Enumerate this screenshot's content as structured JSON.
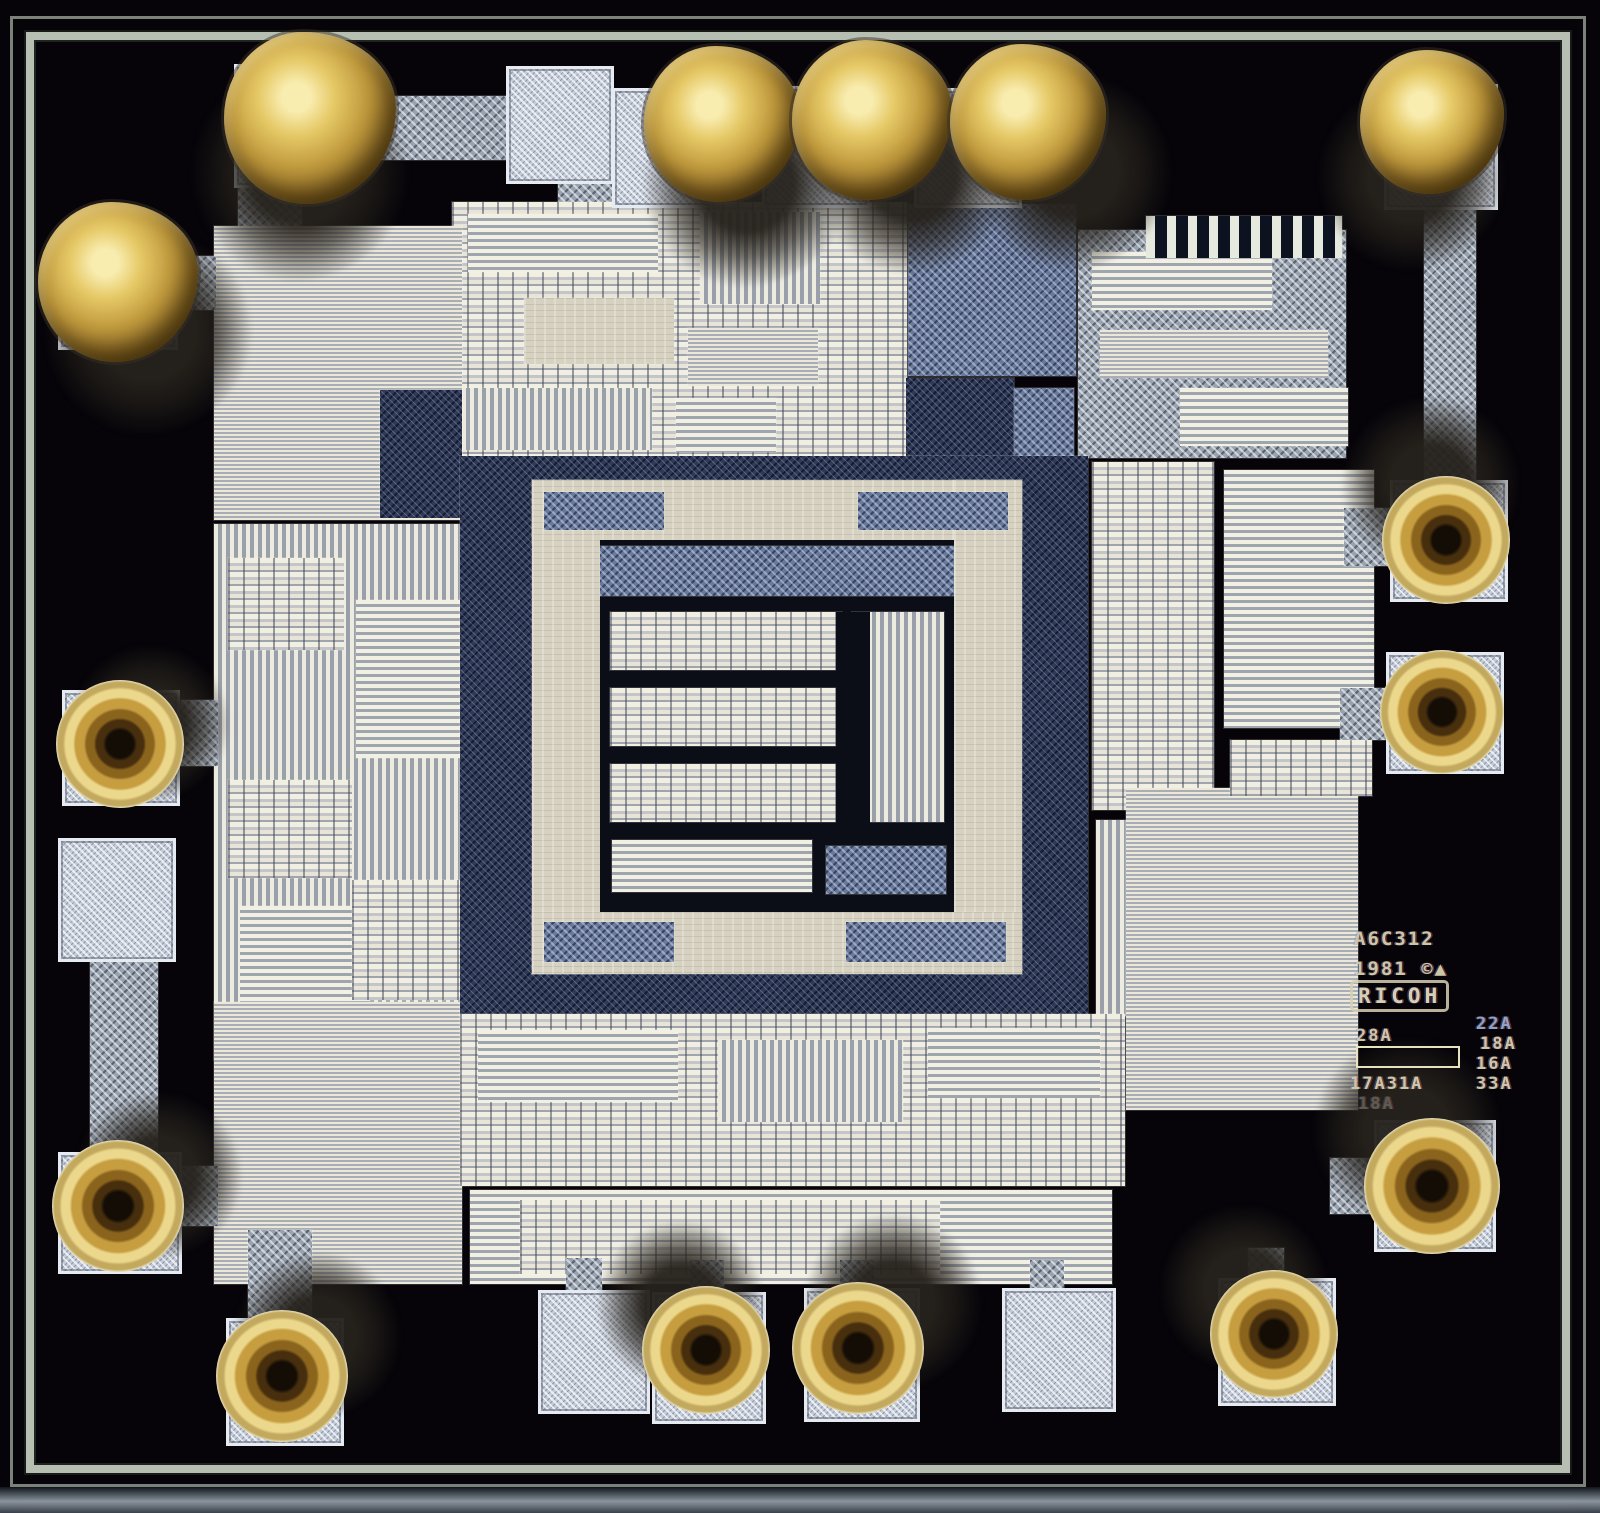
{
  "scene": {
    "subject": "Photomicrograph of an integrated-circuit die with gold wire-bond balls and cratered bond remnants",
    "gold_ball_bonds": 6,
    "cratered_bonds": 9,
    "empty_bond_pads": 4
  },
  "palette": {
    "die_background": "#060409",
    "seal_ring": "#b7bfb2",
    "bond_pad": "#c3cbd8",
    "metal_speckle": "#99a3b0",
    "blue_speckle": "#68799c",
    "navy_speckle": "#2f3a58",
    "stripe_light": "#ece8d9",
    "stripe_dark": "#a9aeb6",
    "core_beige": "#d6d1c0",
    "gold": "#e6c967",
    "gold_dark": "#6b4f17",
    "marking_text": "#ccc6a4"
  },
  "markings": {
    "part_number": "A6C312",
    "copyright_line": "1981 ©▲",
    "logo": "RICOH",
    "rev_left_top": "28A",
    "rev_right_1": "22A",
    "rev_right_2": "18A",
    "rev_right_3": "16A",
    "rev_bottom_left": "17A31A",
    "rev_bottom_right": "33A",
    "rev_faint": "18A"
  },
  "die": {
    "regions": [
      {
        "name": "trace-top-left-h",
        "p": "p-speck",
        "x": 296,
        "y": 96,
        "w": 218,
        "h": 64
      },
      {
        "name": "trace-top-left-v",
        "p": "p-speck",
        "x": 238,
        "y": 158,
        "w": 64,
        "h": 70
      },
      {
        "name": "trace-top-pad-stub",
        "p": "p-speck",
        "x": 558,
        "y": 168,
        "w": 58,
        "h": 62
      },
      {
        "name": "logic-block-top-center",
        "p": "p-cells",
        "x": 452,
        "y": 202,
        "w": 455,
        "h": 258
      },
      {
        "name": "top-center-stripe-a",
        "p": "p-hstripe2",
        "x": 468,
        "y": 214,
        "w": 190,
        "h": 58
      },
      {
        "name": "top-center-stripe-b",
        "p": "p-vstripe",
        "x": 700,
        "y": 212,
        "w": 120,
        "h": 92
      },
      {
        "name": "top-center-plate",
        "p": "p-beige",
        "x": 524,
        "y": 298,
        "w": 150,
        "h": 66
      },
      {
        "name": "top-center-stripe-c",
        "p": "p-hstripe",
        "x": 688,
        "y": 328,
        "w": 130,
        "h": 58
      },
      {
        "name": "top-center-stripe-d",
        "p": "p-vstripe",
        "x": 462,
        "y": 388,
        "w": 190,
        "h": 62
      },
      {
        "name": "top-center-stripe-e",
        "p": "p-hstripe2",
        "x": 676,
        "y": 398,
        "w": 100,
        "h": 54
      },
      {
        "name": "metal-column-a",
        "p": "p-speckb",
        "x": 908,
        "y": 204,
        "w": 168,
        "h": 172
      },
      {
        "name": "navy-patch-a",
        "p": "p-specknavy",
        "x": 906,
        "y": 378,
        "w": 108,
        "h": 82
      },
      {
        "name": "speckle-patch-b",
        "p": "p-speckb",
        "x": 1014,
        "y": 388,
        "w": 60,
        "h": 70
      },
      {
        "name": "block-top-right",
        "p": "p-speck",
        "x": 1078,
        "y": 230,
        "w": 268,
        "h": 228
      },
      {
        "name": "top-right-stripe-a",
        "p": "p-hstripe2",
        "x": 1092,
        "y": 252,
        "w": 180,
        "h": 58
      },
      {
        "name": "top-right-stripe-b",
        "p": "p-hstripe",
        "x": 1100,
        "y": 330,
        "w": 228,
        "h": 48
      },
      {
        "name": "top-right-stripe-c",
        "p": "p-hstripe2",
        "x": 1180,
        "y": 388,
        "w": 168,
        "h": 58
      },
      {
        "name": "trim-comb-fingers",
        "p": "p-comb",
        "x": 1146,
        "y": 216,
        "w": 196,
        "h": 42
      },
      {
        "name": "trace-top-right-v",
        "p": "p-speck",
        "x": 1424,
        "y": 192,
        "w": 52,
        "h": 288
      },
      {
        "name": "resistor-array-left-top",
        "p": "p-hstripe",
        "x": 214,
        "y": 226,
        "w": 248,
        "h": 294
      },
      {
        "name": "left-top-inset",
        "p": "p-specknavy",
        "x": 380,
        "y": 390,
        "w": 82,
        "h": 128
      },
      {
        "name": "analog-block-left",
        "p": "p-vstripe",
        "x": 214,
        "y": 524,
        "w": 262,
        "h": 536
      },
      {
        "name": "analog-left-cells-a",
        "p": "p-cells",
        "x": 228,
        "y": 558,
        "w": 116,
        "h": 92
      },
      {
        "name": "analog-left-stripe-a",
        "p": "p-hstripe2",
        "x": 356,
        "y": 600,
        "w": 104,
        "h": 158
      },
      {
        "name": "analog-left-cells-b",
        "p": "p-cells",
        "x": 228,
        "y": 780,
        "w": 124,
        "h": 98
      },
      {
        "name": "analog-left-stripe-b",
        "p": "p-hstripe2",
        "x": 240,
        "y": 906,
        "w": 130,
        "h": 96
      },
      {
        "name": "analog-left-cells-c",
        "p": "p-cells",
        "x": 352,
        "y": 880,
        "w": 108,
        "h": 120
      },
      {
        "name": "resistor-array-left-bottom",
        "p": "p-hstripe",
        "x": 214,
        "y": 1002,
        "w": 248,
        "h": 282
      },
      {
        "name": "trace-left-a",
        "p": "p-speck",
        "x": 166,
        "y": 256,
        "w": 50,
        "h": 54
      },
      {
        "name": "trace-left-b",
        "p": "p-speck",
        "x": 170,
        "y": 700,
        "w": 48,
        "h": 66
      },
      {
        "name": "trace-left-bus",
        "p": "p-speck",
        "x": 90,
        "y": 956,
        "w": 68,
        "h": 200
      },
      {
        "name": "trace-left-c",
        "p": "p-speck",
        "x": 176,
        "y": 1166,
        "w": 42,
        "h": 60
      },
      {
        "name": "trace-bottom-left-v",
        "p": "p-speck",
        "x": 248,
        "y": 1230,
        "w": 64,
        "h": 92
      },
      {
        "name": "core-moat",
        "p": "p-specknavy",
        "x": 460,
        "y": 456,
        "w": 628,
        "h": 560
      },
      {
        "name": "core-frame-top",
        "p": "p-beige",
        "x": 532,
        "y": 480,
        "w": 490,
        "h": 60
      },
      {
        "name": "core-frame-left",
        "p": "p-beige",
        "x": 532,
        "y": 480,
        "w": 68,
        "h": 494
      },
      {
        "name": "core-frame-right",
        "p": "p-beige",
        "x": 954,
        "y": 480,
        "w": 68,
        "h": 494
      },
      {
        "name": "core-frame-bottom",
        "p": "p-beige",
        "x": 532,
        "y": 912,
        "w": 490,
        "h": 62
      },
      {
        "name": "frame-patch-a",
        "p": "p-speckb",
        "x": 544,
        "y": 492,
        "w": 120,
        "h": 38
      },
      {
        "name": "frame-patch-b",
        "p": "p-speckb",
        "x": 858,
        "y": 492,
        "w": 150,
        "h": 38
      },
      {
        "name": "frame-patch-c",
        "p": "p-speckb",
        "x": 544,
        "y": 922,
        "w": 130,
        "h": 40
      },
      {
        "name": "frame-patch-d",
        "p": "p-speckb",
        "x": 846,
        "y": 922,
        "w": 160,
        "h": 40
      },
      {
        "name": "core-inner-field",
        "p": "p-black",
        "x": 600,
        "y": 540,
        "w": 354,
        "h": 372
      },
      {
        "name": "core-inner-top",
        "p": "p-speckb",
        "x": 600,
        "y": 546,
        "w": 354,
        "h": 50
      },
      {
        "name": "core-cell-row-1",
        "p": "p-cells",
        "x": 610,
        "y": 612,
        "w": 232,
        "h": 58
      },
      {
        "name": "core-cell-row-2",
        "p": "p-cells",
        "x": 610,
        "y": 688,
        "w": 232,
        "h": 58
      },
      {
        "name": "core-cell-row-3",
        "p": "p-cells",
        "x": 610,
        "y": 764,
        "w": 232,
        "h": 58
      },
      {
        "name": "core-right-column",
        "p": "p-vstripe",
        "x": 852,
        "y": 612,
        "w": 92,
        "h": 210
      },
      {
        "name": "core-cell-row-4",
        "p": "p-hstripe2",
        "x": 612,
        "y": 840,
        "w": 200,
        "h": 52
      },
      {
        "name": "core-br-patch",
        "p": "p-speckb",
        "x": 826,
        "y": 846,
        "w": 120,
        "h": 48
      },
      {
        "name": "core-center-gap",
        "p": "p-black",
        "x": 836,
        "y": 612,
        "w": 34,
        "h": 220
      },
      {
        "name": "cells-right-a",
        "p": "p-cells",
        "x": 1092,
        "y": 462,
        "w": 122,
        "h": 348
      },
      {
        "name": "cells-right-b",
        "p": "p-hstripe2",
        "x": 1224,
        "y": 470,
        "w": 150,
        "h": 258
      },
      {
        "name": "right-vstripe",
        "p": "p-vstripe",
        "x": 1096,
        "y": 820,
        "w": 58,
        "h": 196
      },
      {
        "name": "resistor-array-right",
        "p": "p-hstripe",
        "x": 1126,
        "y": 788,
        "w": 232,
        "h": 322
      },
      {
        "name": "right-cells-c",
        "p": "p-cells",
        "x": 1230,
        "y": 740,
        "w": 142,
        "h": 56
      },
      {
        "name": "trace-right-a",
        "p": "p-speck",
        "x": 1344,
        "y": 508,
        "w": 48,
        "h": 58
      },
      {
        "name": "trace-right-b",
        "p": "p-speck",
        "x": 1340,
        "y": 688,
        "w": 52,
        "h": 52
      },
      {
        "name": "trace-right-c",
        "p": "p-speck",
        "x": 1330,
        "y": 1158,
        "w": 46,
        "h": 56
      },
      {
        "name": "logic-block-bottom",
        "p": "p-cells",
        "x": 460,
        "y": 1014,
        "w": 665,
        "h": 172
      },
      {
        "name": "bottom-stripe-a",
        "p": "p-hstripe2",
        "x": 478,
        "y": 1030,
        "w": 200,
        "h": 72
      },
      {
        "name": "bottom-stripe-b",
        "p": "p-vstripe",
        "x": 718,
        "y": 1040,
        "w": 185,
        "h": 82
      },
      {
        "name": "bottom-stripe-c",
        "p": "p-hstripe2",
        "x": 928,
        "y": 1028,
        "w": 172,
        "h": 70
      },
      {
        "name": "logic-block-bottom-2",
        "p": "p-hstripe2",
        "x": 470,
        "y": 1190,
        "w": 642,
        "h": 94
      },
      {
        "name": "bottom-cells",
        "p": "p-cells",
        "x": 520,
        "y": 1200,
        "w": 420,
        "h": 74
      },
      {
        "name": "pad-stub-a",
        "p": "p-speck",
        "x": 566,
        "y": 1258,
        "w": 36,
        "h": 36
      },
      {
        "name": "pad-stub-b",
        "p": "p-speck",
        "x": 690,
        "y": 1260,
        "w": 34,
        "h": 34
      },
      {
        "name": "pad-stub-c",
        "p": "p-speck",
        "x": 840,
        "y": 1260,
        "w": 34,
        "h": 32
      },
      {
        "name": "pad-stub-d",
        "p": "p-speck",
        "x": 1030,
        "y": 1260,
        "w": 34,
        "h": 32
      },
      {
        "name": "pad-stub-e",
        "p": "p-speck",
        "x": 1248,
        "y": 1248,
        "w": 36,
        "h": 34
      }
    ],
    "pads": [
      {
        "x": 234,
        "y": 64,
        "w": 110,
        "h": 118
      },
      {
        "x": 506,
        "y": 66,
        "w": 102,
        "h": 112
      },
      {
        "x": 612,
        "y": 88,
        "w": 100,
        "h": 114
      },
      {
        "x": 762,
        "y": 86,
        "w": 102,
        "h": 116
      },
      {
        "x": 914,
        "y": 88,
        "w": 102,
        "h": 114
      },
      {
        "x": 1384,
        "y": 84,
        "w": 108,
        "h": 120
      },
      {
        "x": 58,
        "y": 232,
        "w": 114,
        "h": 112
      },
      {
        "x": 62,
        "y": 690,
        "w": 112,
        "h": 110
      },
      {
        "x": 58,
        "y": 838,
        "w": 112,
        "h": 118
      },
      {
        "x": 58,
        "y": 1152,
        "w": 118,
        "h": 116
      },
      {
        "x": 226,
        "y": 1318,
        "w": 112,
        "h": 122
      },
      {
        "x": 538,
        "y": 1290,
        "w": 106,
        "h": 118
      },
      {
        "x": 652,
        "y": 1292,
        "w": 108,
        "h": 126
      },
      {
        "x": 804,
        "y": 1288,
        "w": 110,
        "h": 128
      },
      {
        "x": 1002,
        "y": 1288,
        "w": 108,
        "h": 118
      },
      {
        "x": 1218,
        "y": 1278,
        "w": 112,
        "h": 122
      },
      {
        "x": 1390,
        "y": 480,
        "w": 112,
        "h": 116
      },
      {
        "x": 1386,
        "y": 652,
        "w": 112,
        "h": 116
      },
      {
        "x": 1374,
        "y": 1120,
        "w": 116,
        "h": 126
      }
    ],
    "bonds": [
      {
        "t": "ball",
        "cx": 310,
        "cy": 118,
        "r": 86,
        "sx": -10,
        "sy": 55,
        "sr": 110
      },
      {
        "t": "ball",
        "cx": 722,
        "cy": 124,
        "r": 78,
        "sx": 25,
        "sy": 60,
        "sr": 105
      },
      {
        "t": "ball",
        "cx": 872,
        "cy": 120,
        "r": 80,
        "sx": 40,
        "sy": 55,
        "sr": 100
      },
      {
        "t": "ball",
        "cx": 1028,
        "cy": 122,
        "r": 78,
        "sx": 45,
        "sy": 50,
        "sr": 100
      },
      {
        "t": "ball",
        "cx": 1432,
        "cy": 122,
        "r": 72,
        "sx": -20,
        "sy": 55,
        "sr": 95
      },
      {
        "t": "ball",
        "cx": 118,
        "cy": 282,
        "r": 80,
        "sx": 30,
        "sy": 50,
        "sr": 105
      },
      {
        "t": "crater",
        "cx": 120,
        "cy": 744,
        "r": 64,
        "sx": 30,
        "sy": -20,
        "sr": 80
      },
      {
        "t": "crater",
        "cx": 118,
        "cy": 1206,
        "r": 66,
        "sx": 40,
        "sy": -30,
        "sr": 85
      },
      {
        "t": "crater",
        "cx": 282,
        "cy": 1376,
        "r": 66,
        "sx": 35,
        "sy": -40,
        "sr": 85
      },
      {
        "t": "crater",
        "cx": 706,
        "cy": 1350,
        "r": 64,
        "sx": -25,
        "sy": -45,
        "sr": 85
      },
      {
        "t": "crater",
        "cx": 858,
        "cy": 1348,
        "r": 66,
        "sx": 35,
        "sy": -45,
        "sr": 90
      },
      {
        "t": "crater",
        "cx": 1274,
        "cy": 1334,
        "r": 64,
        "sx": -30,
        "sy": -45,
        "sr": 85
      },
      {
        "t": "crater",
        "cx": 1446,
        "cy": 540,
        "r": 64,
        "sx": -15,
        "sy": -55,
        "sr": 90
      },
      {
        "t": "crater",
        "cx": 1442,
        "cy": 712,
        "r": 62,
        "sx": 0,
        "sy": 0,
        "sr": 0
      },
      {
        "t": "crater",
        "cx": 1432,
        "cy": 1186,
        "r": 68,
        "sx": -25,
        "sy": -55,
        "sr": 95
      }
    ]
  }
}
